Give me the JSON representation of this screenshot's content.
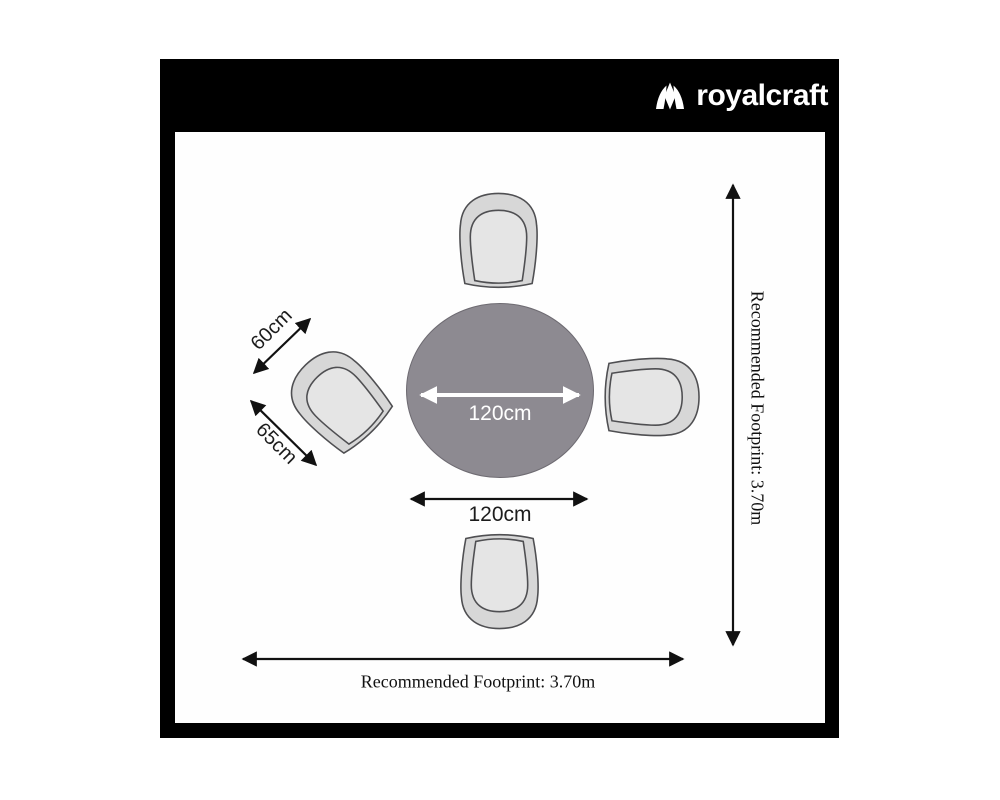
{
  "brand": {
    "logo_text": "royalcraft",
    "logo_icon": "crown-icon"
  },
  "diagram": {
    "title_context": "round dining table with 4 chairs - top view dimension diagram",
    "labels": {
      "table_diameter": "120cm",
      "table_width": "120cm",
      "chair_width": "60cm",
      "chair_depth": "65cm",
      "footprint_vertical": "Recommended Footprint: 3.70m",
      "footprint_horizontal": "Recommended Footprint: 3.70m"
    },
    "dimensions": {
      "table_diameter_cm": 120,
      "chair_width_cm": 60,
      "chair_depth_cm": 65,
      "recommended_footprint_m": 3.7,
      "chair_count": 4
    }
  },
  "colors": {
    "frame_background": "#000000",
    "canvas_background": "#fefefe",
    "table_fill": "#8d8a91",
    "table_stroke": "#6e6b72",
    "chair_fill": "#d7d7d7",
    "chair_seat_fill": "#e5e5e5",
    "chair_stroke": "#4f4f52",
    "arrow_black": "#111111",
    "arrow_white": "#ffffff",
    "logo_color": "#ffffff"
  }
}
